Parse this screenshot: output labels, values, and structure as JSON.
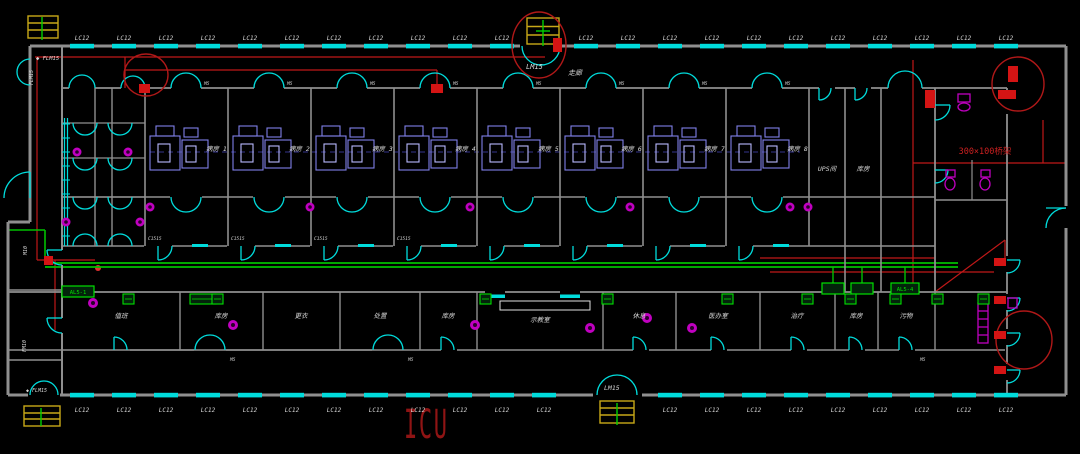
{
  "drawing": {
    "big_label": "ICU",
    "window_label": "LC12",
    "lm15": "LM15",
    "flm15": "FLM15",
    "flm15_marked": "◆ FLM15",
    "cable_tray_note": "300×100桥架",
    "corridor_label": "走廊",
    "door_tag": "M5",
    "window_tag": "C1515",
    "left_door_tags": [
      "M10",
      "FM10"
    ],
    "ward_rooms": [
      "病房 1",
      "病房 2",
      "病房 3",
      "病房 4",
      "病房 5",
      "病房 6",
      "病房 7",
      "病房 8"
    ],
    "right_rooms": [
      "UPS间",
      "库房"
    ],
    "bottom_rooms": [
      "值班",
      "库房",
      "更衣",
      "处置",
      "库房",
      "示教室",
      "休息",
      "医办室",
      "治疗",
      "库房",
      "污物"
    ],
    "panel_boxes": [
      "AL5-1",
      "AL5-4"
    ],
    "colors": {
      "background": "#000000",
      "wall_gray": "#8f8f8f",
      "door_window_cyan": "#00dcdc",
      "wiring_red": "#c01818",
      "annotation_red": "#b01818",
      "tray_green": "#00c000",
      "tag_green": "#00e000",
      "panel_yellow": "#c8a818",
      "fixture_magenta": "#c000c0",
      "bed_blue": "#8080e8",
      "text_white": "#d8d8d8",
      "icu_red": "#8f1414"
    }
  }
}
